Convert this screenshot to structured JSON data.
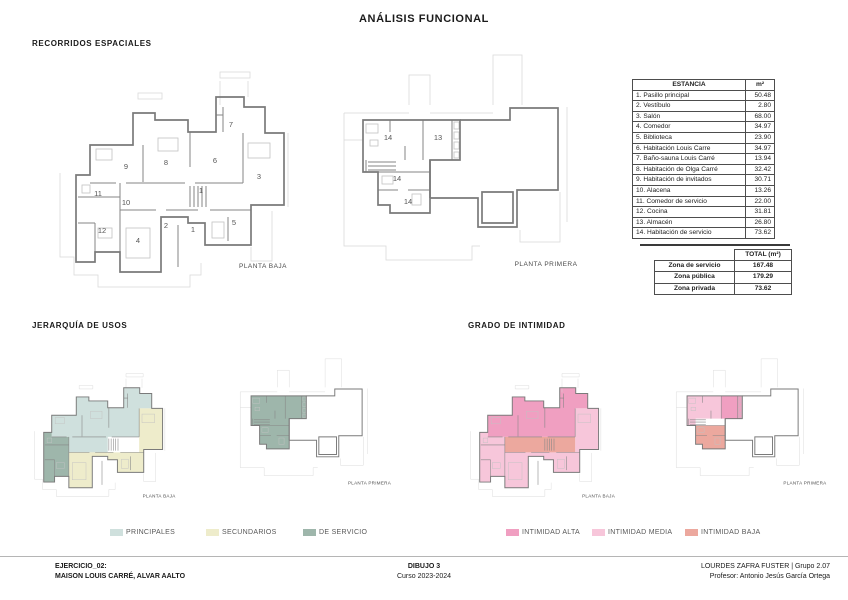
{
  "page": {
    "title": "ANÁLISIS FUNCIONAL"
  },
  "sections": {
    "recorridos": {
      "title": "RECORRIDOS ESPACIALES"
    },
    "jerarquia": {
      "title": "JERARQUÍA DE USOS"
    },
    "intimidad": {
      "title": "GRADO DE INTIMIDAD"
    }
  },
  "plans": [
    {
      "id": "plan-recorridos-baja",
      "type": "baja",
      "zones": "",
      "caption": "PLANTA BAJA",
      "rooms": [
        {
          "n": "9",
          "x": 88,
          "y": 124
        },
        {
          "n": "8",
          "x": 128,
          "y": 120
        },
        {
          "n": "6",
          "x": 177,
          "y": 118
        },
        {
          "n": "7",
          "x": 193,
          "y": 82
        },
        {
          "n": "3",
          "x": 221,
          "y": 134
        },
        {
          "n": "1",
          "x": 163,
          "y": 148
        },
        {
          "n": "11",
          "x": 60,
          "y": 151
        },
        {
          "n": "10",
          "x": 88,
          "y": 160
        },
        {
          "n": "2",
          "x": 128,
          "y": 183
        },
        {
          "n": "1",
          "x": 155,
          "y": 187
        },
        {
          "n": "5",
          "x": 196,
          "y": 180
        },
        {
          "n": "12",
          "x": 64,
          "y": 188
        },
        {
          "n": "4",
          "x": 100,
          "y": 198
        }
      ]
    },
    {
      "id": "plan-recorridos-primera",
      "type": "primera",
      "zones": "",
      "caption": "PLANTA PRIMERA",
      "rooms": [
        {
          "n": "14",
          "x": 58,
          "y": 90
        },
        {
          "n": "13",
          "x": 108,
          "y": 90
        },
        {
          "n": "14",
          "x": 67,
          "y": 131
        },
        {
          "n": "14",
          "x": 78,
          "y": 154
        }
      ]
    },
    {
      "id": "plan-jerarquia-baja",
      "type": "baja",
      "zones": "jerarquia_baja",
      "caption": "PLANTA BAJA",
      "rooms": []
    },
    {
      "id": "plan-jerarquia-primera",
      "type": "primera",
      "zones": "jerarquia_primera",
      "caption": "PLANTA PRIMERA",
      "rooms": []
    },
    {
      "id": "plan-intimidad-baja",
      "type": "baja",
      "zones": "intimidad_baja",
      "caption": "PLANTA BAJA",
      "rooms": []
    },
    {
      "id": "plan-intimidad-primera",
      "type": "primera",
      "zones": "intimidad_primera",
      "caption": "PLANTA PRIMERA",
      "rooms": []
    }
  ],
  "table": {
    "header": [
      "ESTANCIA",
      "m²"
    ],
    "rows": [
      [
        "1. Pasillo principal",
        "50.48"
      ],
      [
        "2. Vestíbulo",
        "2.80"
      ],
      [
        "3. Salón",
        "68.00"
      ],
      [
        "4. Comedor",
        "34.97"
      ],
      [
        "5. Biblioteca",
        "23.90"
      ],
      [
        "6. Habitación Louis Carre",
        "34.97"
      ],
      [
        "7. Baño-sauna Louis Carré",
        "13.94"
      ],
      [
        "8. Habitación de Olga Carré",
        "32.42"
      ],
      [
        "9. Habitación de invitados",
        "30.71"
      ],
      [
        "10. Alacena",
        "13.26"
      ],
      [
        "11. Comedor de servicio",
        "22.00"
      ],
      [
        "12. Cocina",
        "31.81"
      ],
      [
        "13. Almacén",
        "26.80"
      ],
      [
        "14. Habitación de servicio",
        "73.62"
      ]
    ]
  },
  "totals": {
    "header": "TOTAL (m²)",
    "rows": [
      [
        "Zona de servicio",
        "167.48"
      ],
      [
        "Zona pública",
        "179.29"
      ],
      [
        "Zona privada",
        "73.62"
      ]
    ]
  },
  "legends": {
    "usos": [
      {
        "label": "PRINCIPALES",
        "color": "#cfe0dd"
      },
      {
        "label": "SECUNDARIOS",
        "color": "#eeeccb"
      },
      {
        "label": "DE SERVICIO",
        "color": "#9eb6ab"
      }
    ],
    "intimidad": [
      {
        "label": "INTIMIDAD ALTA",
        "color": "#f09fc1"
      },
      {
        "label": "INTIMIDAD MEDIA",
        "color": "#f7c6da"
      },
      {
        "label": "INTIMIDAD BAJA",
        "color": "#eca89e"
      }
    ]
  },
  "footer": {
    "left_line1": "EJERCICIO_02:",
    "left_line2": "MAISON LOUIS CARRÉ, ALVAR AALTO",
    "center_line1": "DIBUJO 3",
    "center_line2": "Curso 2023-2024",
    "right_line1": "LOURDES ZAFRA FUSTER | Grupo 2.07",
    "right_line2": "Profesor: Antonio Jesús García Ortega"
  }
}
